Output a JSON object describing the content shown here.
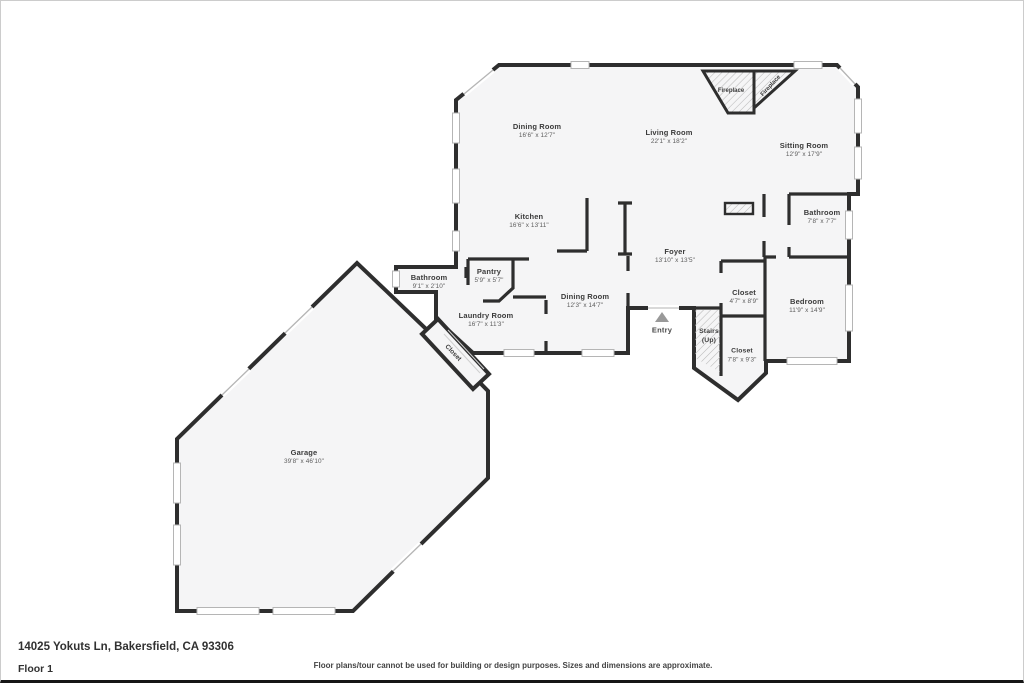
{
  "page": {
    "address": "14025 Yokuts Ln, Bakersfield, CA 93306",
    "floor_label": "Floor 1",
    "disclaimer": "Floor plans/tour cannot be used for building or design purposes. Sizes and dimensions are approximate."
  },
  "colors": {
    "wall": "#2e2e2e",
    "room_fill": "#f5f5f6",
    "window": "#b5b5b5",
    "label_text": "#3b3b3b",
    "dim_text": "#5d5d5d"
  },
  "rooms": [
    {
      "name": "Dining Room",
      "dims": "16'6\" x 12'7\""
    },
    {
      "name": "Living Room",
      "dims": "22'1\" x 18'2\""
    },
    {
      "name": "Sitting Room",
      "dims": "12'9\" x 17'9\""
    },
    {
      "name": "Kitchen",
      "dims": "16'6\" x 13'11\""
    },
    {
      "name": "Bathroom",
      "dims": "7'8\" x 7'7\""
    },
    {
      "name": "Foyer",
      "dims": "13'10\" x 13'5\""
    },
    {
      "name": "Pantry",
      "dims": "5'9\" x 5'7\""
    },
    {
      "name": "Bathroom",
      "dims": "9'1\" x 2'10\""
    },
    {
      "name": "Laundry Room",
      "dims": "16'7\" x 11'3\""
    },
    {
      "name": "Dining Room",
      "dims": "12'3\" x 14'7\""
    },
    {
      "name": "Closet",
      "dims": "4'7\" x 8'9\""
    },
    {
      "name": "Bedroom",
      "dims": "11'9\" x 14'9\""
    },
    {
      "name": "Stairs",
      "dims": "(Up)"
    },
    {
      "name": "Closet",
      "dims": "7'8\" x 9'3\""
    },
    {
      "name": "Garage",
      "dims": "39'8\" x 46'10\""
    }
  ],
  "features": {
    "entry_label": "Entry",
    "fireplaces": [
      "Fireplace",
      "Fireplace"
    ],
    "corridor_closet_label": "Closet"
  }
}
